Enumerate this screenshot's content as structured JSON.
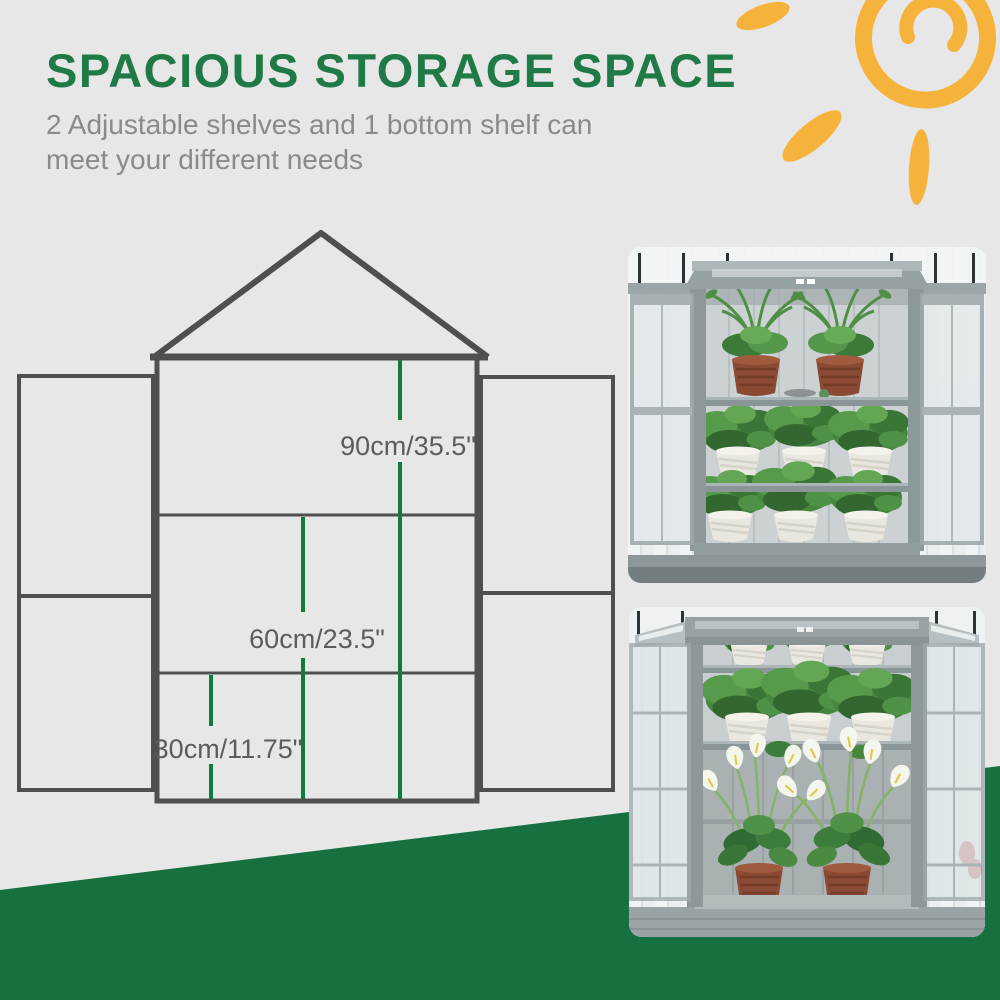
{
  "header": {
    "title": "SPACIOUS STORAGE SPACE",
    "subtitle_line1": "2 Adjustable shelves and 1 bottom shelf can",
    "subtitle_line2": "meet your different needs"
  },
  "diagram": {
    "measurements": [
      {
        "id": "overall-height",
        "label": "90cm/35.5\""
      },
      {
        "id": "middle-height",
        "label": "60cm/23.5\""
      },
      {
        "id": "bottom-height",
        "label": "30cm/11.75\""
      }
    ]
  },
  "colors": {
    "title_green": "#1f7a47",
    "subtitle_gray": "#8a8a8a",
    "diagram_line": "#4f4f4f",
    "measure_green": "#0c7c3f",
    "label_gray": "#5c5c5c",
    "wedge_green": "#177040",
    "sun_yellow": "#f6b33c"
  },
  "photos": [
    {
      "alt": "cold frame greenhouse with plants on three shelves"
    },
    {
      "alt": "cold frame greenhouse with two shelves and calla lilies in bottom storage"
    }
  ]
}
